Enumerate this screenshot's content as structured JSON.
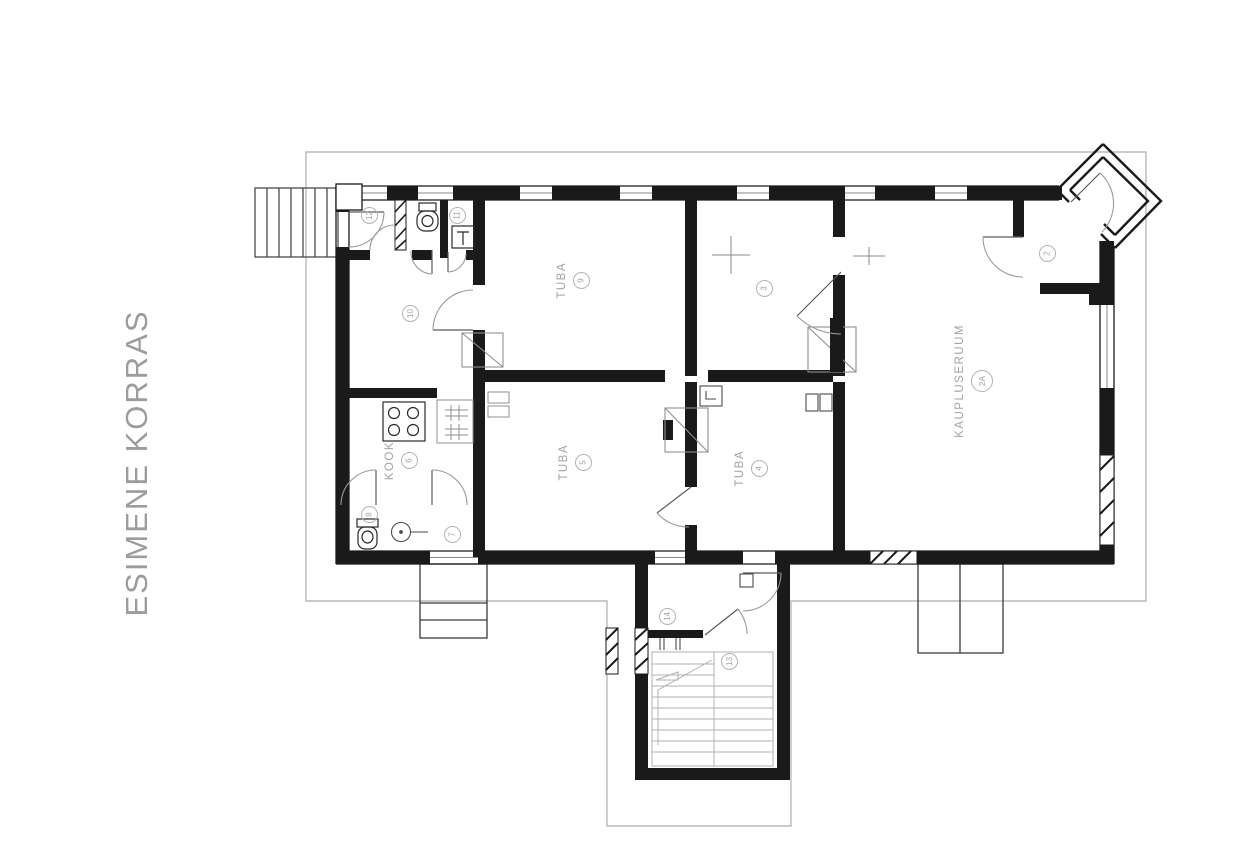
{
  "title": "ESIMENE KORRAS",
  "rooms": [
    {
      "number": "12",
      "name": ""
    },
    {
      "number": "11",
      "name": ""
    },
    {
      "number": "10",
      "name": ""
    },
    {
      "number": "9",
      "name": "TUBA"
    },
    {
      "number": "3",
      "name": ""
    },
    {
      "number": "2",
      "name": ""
    },
    {
      "number": "2A",
      "name": "KAUPLUSERUUM"
    },
    {
      "number": "6",
      "name": "KÖÖK"
    },
    {
      "number": "5",
      "name": "TUBA"
    },
    {
      "number": "4",
      "name": "TUBA"
    },
    {
      "number": "8",
      "name": ""
    },
    {
      "number": "7",
      "name": ""
    },
    {
      "number": "14",
      "name": ""
    },
    {
      "number": "13",
      "name": ""
    }
  ],
  "colors": {
    "wall": "#1a1a1a",
    "label_gray": "#a2a2a2",
    "boundary_gray": "#b8b8b8",
    "background": "#ffffff"
  }
}
